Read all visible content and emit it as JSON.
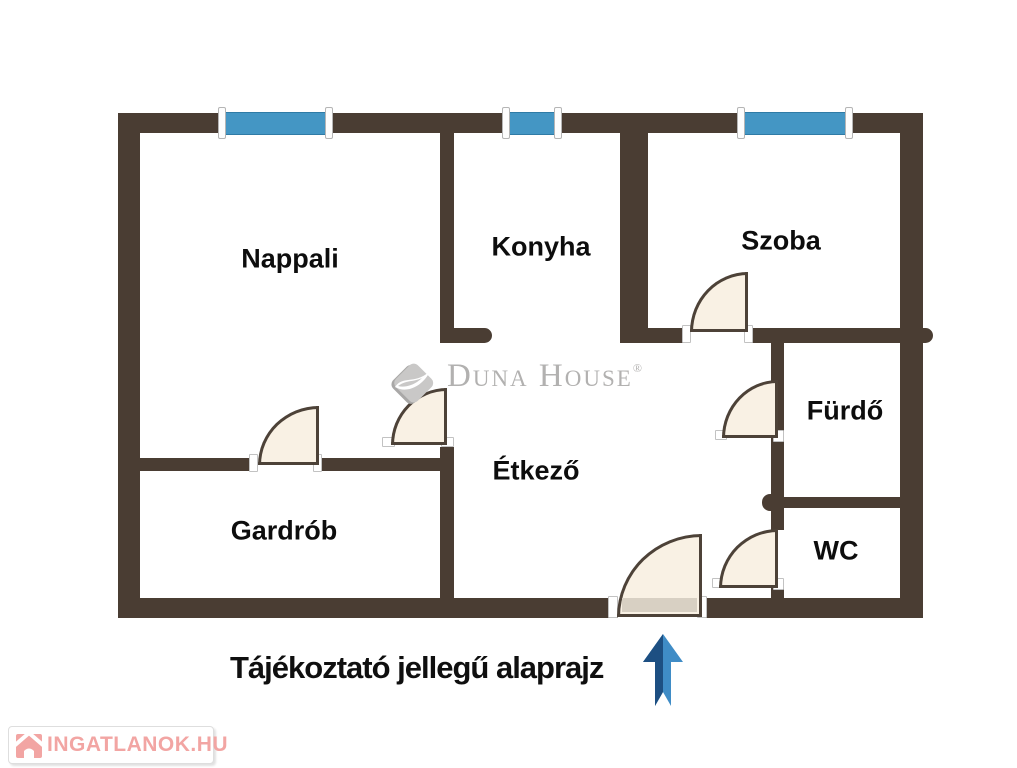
{
  "plan": {
    "rooms": [
      {
        "id": "nappali",
        "label": "Nappali"
      },
      {
        "id": "konyha",
        "label": "Konyha"
      },
      {
        "id": "szoba",
        "label": "Szoba"
      },
      {
        "id": "furdo",
        "label": "Fürdő"
      },
      {
        "id": "wc",
        "label": "WC"
      },
      {
        "id": "etkezo",
        "label": "Étkező"
      },
      {
        "id": "gardrob",
        "label": "Gardrób"
      }
    ]
  },
  "caption": "Tájékoztató jellegű alaprajz",
  "watermark": {
    "brand": "Duna House",
    "registered_mark": "®"
  },
  "logo": {
    "text": "INGATLANOK.HU"
  },
  "colors": {
    "wall": "#4a3d33",
    "window_blue": "#4496c4",
    "door_fill": "#f9f1e4",
    "door_outline": "#4d4238",
    "arrow_light": "#3f8cc6",
    "arrow_dark": "#1d4f82",
    "logo_pink": "#f2a5a3",
    "watermark_gray": "#b2b1b0",
    "label_black": "#0d0d0d"
  }
}
